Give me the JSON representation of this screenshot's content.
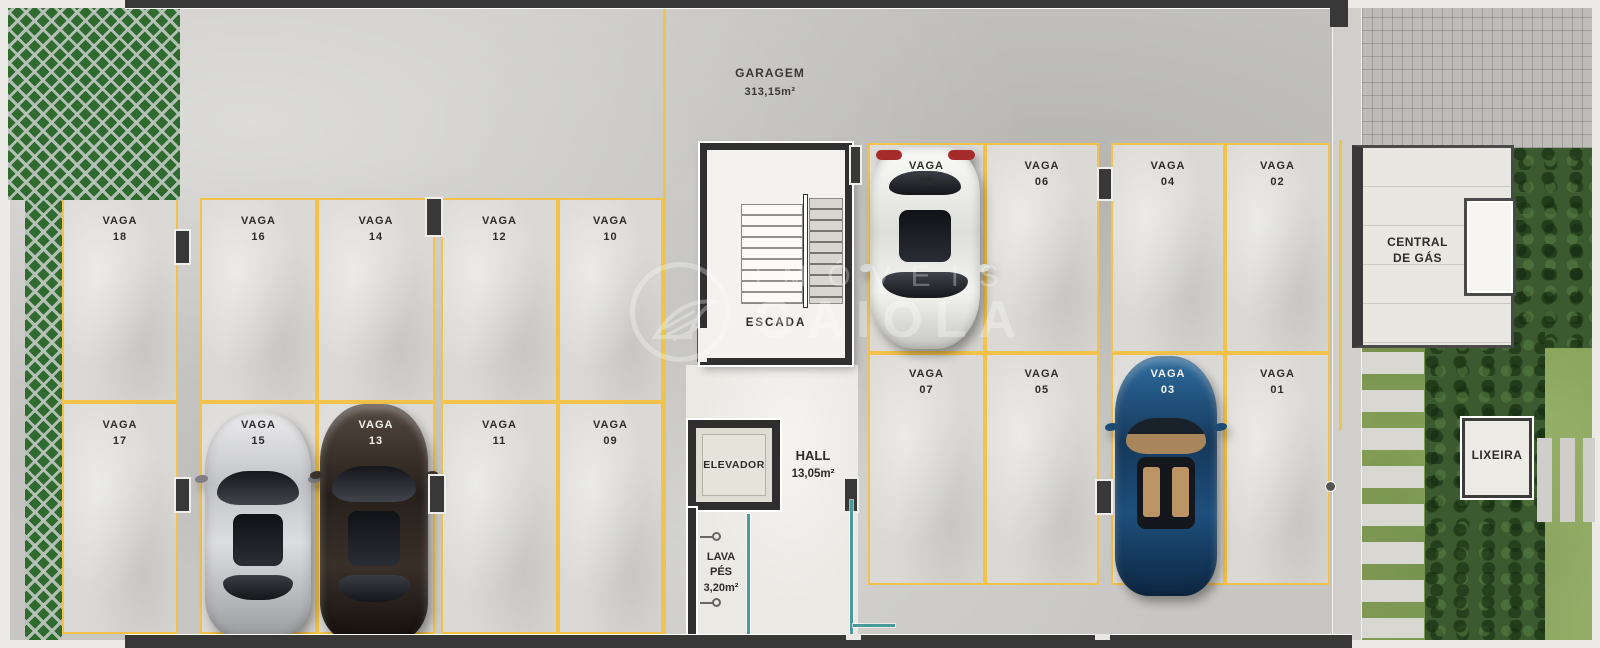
{
  "core": {
    "garage_title": "GARAGEM",
    "garage_area": "313,15m²",
    "escada": "ESCADA",
    "elevador": "ELEVADOR",
    "hall": "HALL",
    "hall_area": "13,05m²",
    "lava1": "LAVA",
    "lava2": "PÉS",
    "lava_area": "3,20m²"
  },
  "annex": {
    "gas1": "CENTRAL",
    "gas2": "DE GÁS",
    "lixeira": "LIXEIRA"
  },
  "stalls": {
    "s01": {
      "word": "VAGA",
      "num": "01"
    },
    "s02": {
      "word": "VAGA",
      "num": "02"
    },
    "s03": {
      "word": "VAGA",
      "num": "03"
    },
    "s04": {
      "word": "VAGA",
      "num": "04"
    },
    "s05": {
      "word": "VAGA",
      "num": "05"
    },
    "s06": {
      "word": "VAGA",
      "num": "06"
    },
    "s07": {
      "word": "VAGA",
      "num": "07"
    },
    "s08": {
      "word": "VAGA",
      "num": "08"
    },
    "s09": {
      "word": "VAGA",
      "num": "09"
    },
    "s10": {
      "word": "VAGA",
      "num": "10"
    },
    "s11": {
      "word": "VAGA",
      "num": "11"
    },
    "s12": {
      "word": "VAGA",
      "num": "12"
    },
    "s13": {
      "word": "VAGA",
      "num": "13"
    },
    "s14": {
      "word": "VAGA",
      "num": "14"
    },
    "s15": {
      "word": "VAGA",
      "num": "15"
    },
    "s16": {
      "word": "VAGA",
      "num": "16"
    },
    "s17": {
      "word": "VAGA",
      "num": "17"
    },
    "s18": {
      "word": "VAGA",
      "num": "18"
    }
  },
  "cars": [
    {
      "stall": "15",
      "color": "#c6c7cb"
    },
    {
      "stall": "13",
      "color": "#2e2520"
    },
    {
      "stall": "08",
      "color": "#f0f0ec"
    },
    {
      "stall": "03",
      "color": "#1d4f7c"
    }
  ],
  "watermark": {
    "line1": "IMÓVEIS",
    "line2": "GAIOLA"
  },
  "colors": {
    "stall_line": "#f2c24b",
    "wall": "#383838",
    "lattice": "#2f6a2f",
    "grass": "#87a158",
    "hedge": "#3b5a2f",
    "glass": "#4a9a9b"
  }
}
